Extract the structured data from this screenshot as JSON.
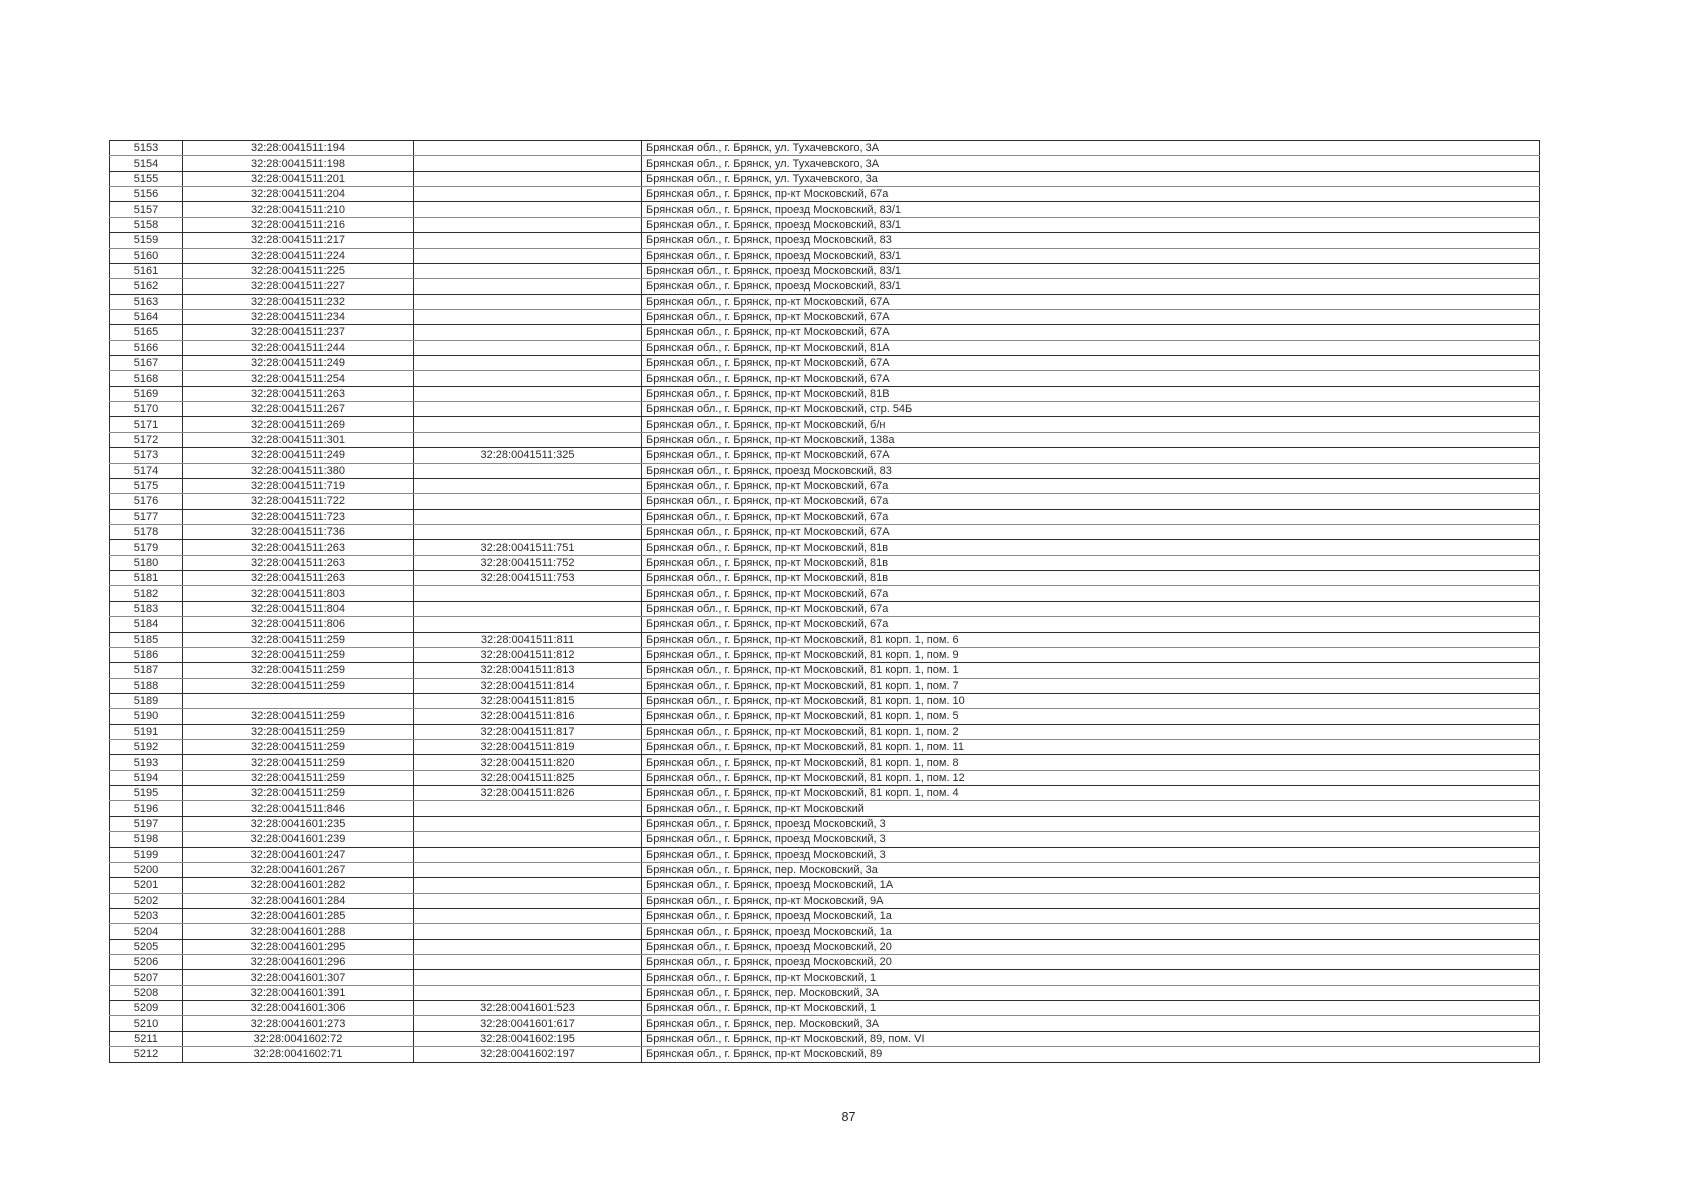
{
  "page_number": "87",
  "table": {
    "rows": [
      {
        "no": "5153",
        "cad1": "32:28:0041511:194",
        "cad2": "",
        "address": "Брянская обл., г. Брянск, ул. Тухачевского, 3А"
      },
      {
        "no": "5154",
        "cad1": "32:28:0041511:198",
        "cad2": "",
        "address": "Брянская обл., г. Брянск, ул. Тухачевского, 3А"
      },
      {
        "no": "5155",
        "cad1": "32:28:0041511:201",
        "cad2": "",
        "address": "Брянская обл., г. Брянск, ул. Тухачевского, 3а"
      },
      {
        "no": "5156",
        "cad1": "32:28:0041511:204",
        "cad2": "",
        "address": "Брянская обл., г. Брянск, пр-кт Московский, 67а"
      },
      {
        "no": "5157",
        "cad1": "32:28:0041511:210",
        "cad2": "",
        "address": "Брянская обл., г. Брянск, проезд Московский, 83/1"
      },
      {
        "no": "5158",
        "cad1": "32:28:0041511:216",
        "cad2": "",
        "address": "Брянская обл., г. Брянск, проезд Московский, 83/1"
      },
      {
        "no": "5159",
        "cad1": "32:28:0041511:217",
        "cad2": "",
        "address": "Брянская обл., г. Брянск, проезд Московский, 83"
      },
      {
        "no": "5160",
        "cad1": "32:28:0041511:224",
        "cad2": "",
        "address": "Брянская обл., г. Брянск, проезд Московский, 83/1"
      },
      {
        "no": "5161",
        "cad1": "32:28:0041511:225",
        "cad2": "",
        "address": "Брянская обл., г. Брянск, проезд Московский, 83/1"
      },
      {
        "no": "5162",
        "cad1": "32:28:0041511:227",
        "cad2": "",
        "address": "Брянская обл., г. Брянск, проезд Московский, 83/1"
      },
      {
        "no": "5163",
        "cad1": "32:28:0041511:232",
        "cad2": "",
        "address": "Брянская обл., г. Брянск, пр-кт Московский, 67А"
      },
      {
        "no": "5164",
        "cad1": "32:28:0041511:234",
        "cad2": "",
        "address": "Брянская обл., г. Брянск, пр-кт Московский, 67А"
      },
      {
        "no": "5165",
        "cad1": "32:28:0041511:237",
        "cad2": "",
        "address": "Брянская обл., г. Брянск, пр-кт Московский, 67А"
      },
      {
        "no": "5166",
        "cad1": "32:28:0041511:244",
        "cad2": "",
        "address": "Брянская обл., г. Брянск, пр-кт Московский, 81А"
      },
      {
        "no": "5167",
        "cad1": "32:28:0041511:249",
        "cad2": "",
        "address": "Брянская обл., г. Брянск, пр-кт Московский, 67А"
      },
      {
        "no": "5168",
        "cad1": "32:28:0041511:254",
        "cad2": "",
        "address": "Брянская обл., г. Брянск, пр-кт Московский, 67А"
      },
      {
        "no": "5169",
        "cad1": "32:28:0041511:263",
        "cad2": "",
        "address": "Брянская обл., г. Брянск, пр-кт Московский, 81В"
      },
      {
        "no": "5170",
        "cad1": "32:28:0041511:267",
        "cad2": "",
        "address": "Брянская обл., г. Брянск, пр-кт Московский, стр. 54Б"
      },
      {
        "no": "5171",
        "cad1": "32:28:0041511:269",
        "cad2": "",
        "address": "Брянская обл., г. Брянск, пр-кт Московский, б/н"
      },
      {
        "no": "5172",
        "cad1": "32:28:0041511:301",
        "cad2": "",
        "address": "Брянская обл., г. Брянск, пр-кт Московский, 138а"
      },
      {
        "no": "5173",
        "cad1": "32:28:0041511:249",
        "cad2": "32:28:0041511:325",
        "address": "Брянская обл., г. Брянск, пр-кт Московский, 67А"
      },
      {
        "no": "5174",
        "cad1": "32:28:0041511:380",
        "cad2": "",
        "address": "Брянская обл., г. Брянск, проезд Московский, 83"
      },
      {
        "no": "5175",
        "cad1": "32:28:0041511:719",
        "cad2": "",
        "address": "Брянская обл., г. Брянск, пр-кт Московский, 67а"
      },
      {
        "no": "5176",
        "cad1": "32:28:0041511:722",
        "cad2": "",
        "address": "Брянская обл., г. Брянск, пр-кт Московский, 67а"
      },
      {
        "no": "5177",
        "cad1": "32:28:0041511:723",
        "cad2": "",
        "address": "Брянская обл., г. Брянск, пр-кт Московский, 67а"
      },
      {
        "no": "5178",
        "cad1": "32:28:0041511:736",
        "cad2": "",
        "address": "Брянская обл., г. Брянск, пр-кт Московский, 67А"
      },
      {
        "no": "5179",
        "cad1": "32:28:0041511:263",
        "cad2": "32:28:0041511:751",
        "address": "Брянская обл., г. Брянск, пр-кт Московский, 81в"
      },
      {
        "no": "5180",
        "cad1": "32:28:0041511:263",
        "cad2": "32:28:0041511:752",
        "address": "Брянская обл., г. Брянск, пр-кт Московский, 81в"
      },
      {
        "no": "5181",
        "cad1": "32:28:0041511:263",
        "cad2": "32:28:0041511:753",
        "address": "Брянская обл., г. Брянск, пр-кт Московский, 81в"
      },
      {
        "no": "5182",
        "cad1": "32:28:0041511:803",
        "cad2": "",
        "address": "Брянская обл., г. Брянск, пр-кт Московский, 67а"
      },
      {
        "no": "5183",
        "cad1": "32:28:0041511:804",
        "cad2": "",
        "address": "Брянская обл., г. Брянск, пр-кт Московский, 67а"
      },
      {
        "no": "5184",
        "cad1": "32:28:0041511:806",
        "cad2": "",
        "address": "Брянская обл., г. Брянск, пр-кт Московский, 67а"
      },
      {
        "no": "5185",
        "cad1": "32:28:0041511:259",
        "cad2": "32:28:0041511:811",
        "address": "Брянская обл., г. Брянск, пр-кт Московский, 81 корп. 1, пом. 6"
      },
      {
        "no": "5186",
        "cad1": "32:28:0041511:259",
        "cad2": "32:28:0041511:812",
        "address": "Брянская обл., г. Брянск, пр-кт Московский, 81 корп. 1, пом. 9"
      },
      {
        "no": "5187",
        "cad1": "32:28:0041511:259",
        "cad2": "32:28:0041511:813",
        "address": "Брянская обл., г. Брянск, пр-кт Московский, 81 корп. 1, пом. 1"
      },
      {
        "no": "5188",
        "cad1": "32:28:0041511:259",
        "cad2": "32:28:0041511:814",
        "address": "Брянская обл., г. Брянск, пр-кт Московский, 81 корп. 1, пом. 7"
      },
      {
        "no": "5189",
        "cad1": "",
        "cad2": "32:28:0041511:815",
        "address": "Брянская обл., г. Брянск, пр-кт Московский, 81 корп. 1, пом. 10"
      },
      {
        "no": "5190",
        "cad1": "32:28:0041511:259",
        "cad2": "32:28:0041511:816",
        "address": "Брянская обл., г. Брянск, пр-кт Московский, 81 корп. 1, пом. 5"
      },
      {
        "no": "5191",
        "cad1": "32:28:0041511:259",
        "cad2": "32:28:0041511:817",
        "address": "Брянская обл., г. Брянск, пр-кт Московский, 81 корп. 1, пом. 2"
      },
      {
        "no": "5192",
        "cad1": "32:28:0041511:259",
        "cad2": "32:28:0041511:819",
        "address": "Брянская обл., г. Брянск, пр-кт Московский, 81 корп. 1, пом. 11"
      },
      {
        "no": "5193",
        "cad1": "32:28:0041511:259",
        "cad2": "32:28:0041511:820",
        "address": "Брянская обл., г. Брянск, пр-кт Московский, 81 корп. 1, пом. 8"
      },
      {
        "no": "5194",
        "cad1": "32:28:0041511:259",
        "cad2": "32:28:0041511:825",
        "address": "Брянская обл., г. Брянск, пр-кт Московский, 81 корп. 1, пом. 12"
      },
      {
        "no": "5195",
        "cad1": "32:28:0041511:259",
        "cad2": "32:28:0041511:826",
        "address": "Брянская обл., г. Брянск, пр-кт Московский, 81 корп. 1, пом. 4"
      },
      {
        "no": "5196",
        "cad1": "32:28:0041511:846",
        "cad2": "",
        "address": "Брянская обл., г. Брянск, пр-кт Московский"
      },
      {
        "no": "5197",
        "cad1": "32:28:0041601:235",
        "cad2": "",
        "address": "Брянская обл., г. Брянск, проезд Московский, 3"
      },
      {
        "no": "5198",
        "cad1": "32:28:0041601:239",
        "cad2": "",
        "address": "Брянская обл., г. Брянск, проезд Московский, 3"
      },
      {
        "no": "5199",
        "cad1": "32:28:0041601:247",
        "cad2": "",
        "address": "Брянская обл., г. Брянск, проезд Московский, 3"
      },
      {
        "no": "5200",
        "cad1": "32:28:0041601:267",
        "cad2": "",
        "address": "Брянская обл., г. Брянск, пер. Московский, 3а"
      },
      {
        "no": "5201",
        "cad1": "32:28:0041601:282",
        "cad2": "",
        "address": "Брянская обл., г. Брянск, проезд Московский, 1А"
      },
      {
        "no": "5202",
        "cad1": "32:28:0041601:284",
        "cad2": "",
        "address": "Брянская обл., г. Брянск, пр-кт Московский, 9А"
      },
      {
        "no": "5203",
        "cad1": "32:28:0041601:285",
        "cad2": "",
        "address": "Брянская обл., г. Брянск, проезд Московский, 1а"
      },
      {
        "no": "5204",
        "cad1": "32:28:0041601:288",
        "cad2": "",
        "address": "Брянская обл., г. Брянск, проезд Московский, 1а"
      },
      {
        "no": "5205",
        "cad1": "32:28:0041601:295",
        "cad2": "",
        "address": "Брянская обл., г. Брянск, проезд Московский, 20"
      },
      {
        "no": "5206",
        "cad1": "32:28:0041601:296",
        "cad2": "",
        "address": "Брянская обл., г. Брянск, проезд Московский, 20"
      },
      {
        "no": "5207",
        "cad1": "32:28:0041601:307",
        "cad2": "",
        "address": "Брянская обл., г. Брянск, пр-кт Московский, 1"
      },
      {
        "no": "5208",
        "cad1": "32:28:0041601:391",
        "cad2": "",
        "address": "Брянская обл., г. Брянск, пер. Московский, 3А"
      },
      {
        "no": "5209",
        "cad1": "32:28:0041601:306",
        "cad2": "32:28:0041601:523",
        "address": "Брянская обл., г. Брянск, пр-кт Московский, 1"
      },
      {
        "no": "5210",
        "cad1": "32:28:0041601:273",
        "cad2": "32:28:0041601:617",
        "address": "Брянская обл., г. Брянск, пер. Московский, 3А"
      },
      {
        "no": "5211",
        "cad1": "32:28:0041602:72",
        "cad2": "32:28:0041602:195",
        "address": "Брянская обл., г. Брянск, пр-кт Московский, 89, пом. VI"
      },
      {
        "no": "5212",
        "cad1": "32:28:0041602:71",
        "cad2": "32:28:0041602:197",
        "address": "Брянская обл., г. Брянск, пр-кт Московский, 89"
      }
    ]
  }
}
